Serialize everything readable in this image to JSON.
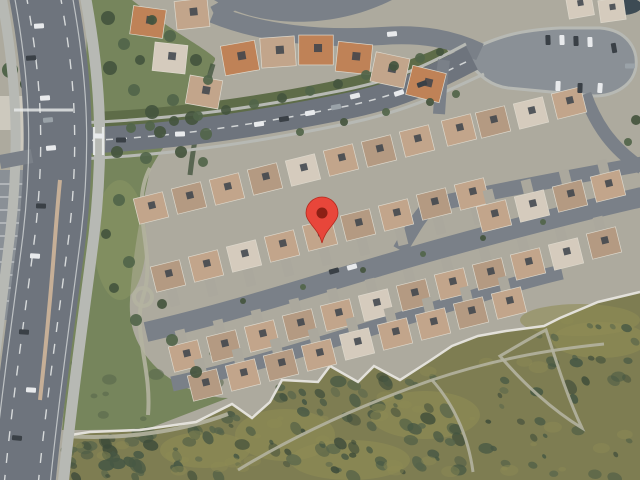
{
  "view": {
    "type": "satellite-map-view",
    "width": 640,
    "height": 480,
    "description": "aerial satellite imagery of a suburban residential neighborhood with a dropped location pin"
  },
  "marker": {
    "x": 322,
    "y": 243,
    "body_color": "#E8463A",
    "dot_color": "#8C2015",
    "outline_color": "#B5291E"
  },
  "palette": {
    "base_ground": "#ADAA9E",
    "road": "#6E747D",
    "road_minor": "#7A8088",
    "parking": "#8A9096",
    "driveway": "#ABA89D",
    "sidewalk": "#B7B9B4",
    "median_tan": "#C6AF97",
    "lane_white": "#EAECEB",
    "park_green": "#76855C",
    "lawn_light": "#8A9665",
    "green_strip": "#5E6C48",
    "tree_dark": "#44553E",
    "tree_mid": "#51654A",
    "hill_base": "#7E7D52",
    "hill_grass": "#8F8C55",
    "scrub_dark": "#475844",
    "scrub_mid": "#56644B",
    "trail": "#B4B2A0",
    "wall_white": "#E7E5DF",
    "roof_tan": "#C2A58B",
    "roof_tan2": "#B49A82",
    "roof_orange": "#BF8257",
    "roof_light": "#D5CBBD",
    "roof_edge": "#DDD8CC",
    "dark_square": "#3C434B",
    "car_white": "#E8EAEC",
    "car_dark": "#3A4046",
    "car_gray": "#9AA2A8",
    "pool_dark": "#3D4B54",
    "building_light": "#CDC9BE"
  },
  "map": {
    "houses": [
      [
        148,
        22,
        8,
        2,
        0,
        1.1
      ],
      [
        192,
        14,
        -6,
        0,
        0,
        1.1
      ],
      [
        170,
        58,
        6,
        3,
        0,
        1.1
      ],
      [
        204,
        92,
        10,
        0,
        0,
        1.1
      ],
      [
        240,
        58,
        -10,
        2,
        0,
        1.15
      ],
      [
        278,
        52,
        -4,
        0,
        0,
        1.15
      ],
      [
        316,
        50,
        0,
        2,
        0,
        1.15
      ],
      [
        354,
        58,
        6,
        2,
        0,
        1.15
      ],
      [
        390,
        70,
        12,
        0,
        0,
        1.15
      ],
      [
        426,
        84,
        14,
        2,
        0,
        1.15
      ],
      [
        151,
        208,
        -14,
        0,
        0,
        1
      ],
      [
        189,
        198,
        -14,
        1,
        0,
        1
      ],
      [
        227,
        189,
        -14,
        0,
        0,
        1
      ],
      [
        265,
        179,
        -14,
        1,
        0,
        1
      ],
      [
        303,
        170,
        -14,
        3,
        0,
        1
      ],
      [
        341,
        160,
        -14,
        0,
        0,
        1
      ],
      [
        379,
        151,
        -14,
        1,
        0,
        1
      ],
      [
        417,
        141,
        -14,
        0,
        0,
        1
      ],
      [
        459,
        130,
        -14,
        0,
        0,
        1
      ],
      [
        493,
        122,
        -14,
        1,
        0,
        1
      ],
      [
        531,
        113,
        -14,
        3,
        0,
        1
      ],
      [
        569,
        103,
        -14,
        0,
        0,
        1
      ],
      [
        168,
        276,
        -14,
        1,
        1,
        1
      ],
      [
        206,
        266,
        -14,
        0,
        1,
        1
      ],
      [
        244,
        256,
        -14,
        3,
        1,
        1
      ],
      [
        282,
        246,
        -14,
        0,
        1,
        1
      ],
      [
        320,
        235,
        -14,
        0,
        1,
        1
      ],
      [
        358,
        225,
        -14,
        1,
        1,
        1
      ],
      [
        396,
        215,
        -14,
        0,
        1,
        1
      ],
      [
        434,
        204,
        -14,
        1,
        1,
        1
      ],
      [
        472,
        194,
        -14,
        0,
        1,
        1
      ],
      [
        494,
        216,
        -14,
        0,
        -1,
        1
      ],
      [
        532,
        206,
        -14,
        3,
        -1,
        1
      ],
      [
        570,
        196,
        -14,
        1,
        -1,
        1
      ],
      [
        608,
        186,
        -14,
        0,
        -1,
        1
      ],
      [
        186,
        356,
        -14,
        0,
        -1,
        1
      ],
      [
        224,
        346,
        -14,
        1,
        -1,
        1
      ],
      [
        262,
        336,
        -14,
        0,
        -1,
        1
      ],
      [
        300,
        325,
        -14,
        1,
        -1,
        1
      ],
      [
        338,
        315,
        -14,
        0,
        -1,
        1
      ],
      [
        376,
        305,
        -14,
        3,
        -1,
        1
      ],
      [
        414,
        295,
        -14,
        1,
        -1,
        1
      ],
      [
        452,
        284,
        -14,
        0,
        -1,
        1
      ],
      [
        490,
        274,
        -14,
        1,
        -1,
        1
      ],
      [
        528,
        264,
        -14,
        0,
        -1,
        1
      ],
      [
        566,
        254,
        -14,
        3,
        -1,
        1
      ],
      [
        604,
        243,
        -14,
        1,
        -1,
        1
      ],
      [
        205,
        385,
        -14,
        1,
        -1,
        1
      ],
      [
        243,
        375,
        -14,
        0,
        -1,
        1
      ],
      [
        281,
        365,
        -14,
        1,
        -1,
        1
      ],
      [
        319,
        355,
        -14,
        0,
        -1,
        1
      ],
      [
        357,
        344,
        -14,
        3,
        -1,
        1
      ],
      [
        395,
        334,
        -14,
        0,
        -1,
        1
      ],
      [
        433,
        324,
        -14,
        0,
        -1,
        1
      ],
      [
        471,
        313,
        -14,
        1,
        -1,
        1
      ],
      [
        509,
        303,
        -14,
        0,
        -1,
        1
      ],
      [
        580,
        6,
        -10,
        3,
        0,
        0.85
      ],
      [
        612,
        10,
        -8,
        3,
        0,
        0.85
      ]
    ],
    "trees": [
      [
        108,
        18,
        7
      ],
      [
        124,
        44,
        6
      ],
      [
        110,
        68,
        7
      ],
      [
        134,
        90,
        6
      ],
      [
        152,
        112,
        7
      ],
      [
        173,
        100,
        6
      ],
      [
        192,
        118,
        7
      ],
      [
        206,
        134,
        6
      ],
      [
        160,
        132,
        6
      ],
      [
        131,
        128,
        5
      ],
      [
        117,
        152,
        6
      ],
      [
        146,
        158,
        6
      ],
      [
        181,
        152,
        6
      ],
      [
        203,
        162,
        5
      ],
      [
        152,
        20,
        5
      ],
      [
        170,
        36,
        6
      ],
      [
        196,
        60,
        6
      ],
      [
        208,
        80,
        5
      ],
      [
        140,
        60,
        5
      ],
      [
        119,
        200,
        6
      ],
      [
        106,
        234,
        5
      ],
      [
        129,
        262,
        6
      ],
      [
        114,
        288,
        5
      ],
      [
        136,
        320,
        6
      ],
      [
        162,
        304,
        5
      ],
      [
        172,
        340,
        6
      ],
      [
        196,
        372,
        6
      ],
      [
        150,
        126,
        5
      ],
      [
        174,
        121,
        5
      ],
      [
        198,
        116,
        5
      ],
      [
        226,
        110,
        5
      ],
      [
        254,
        104,
        5
      ],
      [
        282,
        98,
        5
      ],
      [
        310,
        91,
        5
      ],
      [
        338,
        84,
        5
      ],
      [
        366,
        75,
        5
      ],
      [
        394,
        66,
        5
      ],
      [
        420,
        58,
        5
      ],
      [
        440,
        52,
        4
      ],
      [
        300,
        132,
        4
      ],
      [
        344,
        122,
        4
      ],
      [
        386,
        112,
        4
      ],
      [
        430,
        102,
        4
      ],
      [
        456,
        94,
        4
      ],
      [
        243,
        301,
        3
      ],
      [
        303,
        287,
        3
      ],
      [
        363,
        270,
        3
      ],
      [
        423,
        254,
        3
      ],
      [
        483,
        238,
        3
      ],
      [
        543,
        222,
        3
      ],
      [
        636,
        120,
        5
      ],
      [
        628,
        142,
        4
      ]
    ],
    "cars": [
      [
        39,
        26,
        -4,
        "w"
      ],
      [
        31,
        58,
        -4,
        "d"
      ],
      [
        45,
        98,
        -4,
        "w"
      ],
      [
        51,
        148,
        -6,
        "w"
      ],
      [
        48,
        120,
        -5,
        "g"
      ],
      [
        41,
        206,
        2,
        "d"
      ],
      [
        35,
        256,
        3,
        "w"
      ],
      [
        24,
        332,
        4,
        "d"
      ],
      [
        31,
        390,
        4,
        "w"
      ],
      [
        17,
        438,
        5,
        "d"
      ],
      [
        99,
        136,
        2,
        "w"
      ],
      [
        121,
        140,
        0,
        "d"
      ],
      [
        180,
        134,
        -2,
        "w"
      ],
      [
        259,
        124,
        -8,
        "w"
      ],
      [
        284,
        119,
        -9,
        "d"
      ],
      [
        310,
        113,
        -10,
        "w"
      ],
      [
        336,
        107,
        -11,
        "g"
      ],
      [
        399,
        93,
        -18,
        "w"
      ],
      [
        422,
        84,
        -20,
        "d"
      ],
      [
        355,
        96,
        -13,
        "w"
      ],
      [
        392,
        34,
        -6,
        "w"
      ],
      [
        548,
        40,
        88,
        "d"
      ],
      [
        562,
        40,
        88,
        "w"
      ],
      [
        576,
        41,
        88,
        "d"
      ],
      [
        590,
        42,
        88,
        "w"
      ],
      [
        614,
        48,
        80,
        "d"
      ],
      [
        558,
        86,
        92,
        "w"
      ],
      [
        580,
        88,
        92,
        "d"
      ],
      [
        600,
        88,
        94,
        "w"
      ],
      [
        630,
        66,
        0,
        "g"
      ],
      [
        334,
        271,
        -15,
        "d"
      ],
      [
        352,
        267,
        -15,
        "w"
      ]
    ],
    "hill_wall": [
      [
        64,
        436
      ],
      [
        90,
        432
      ],
      [
        140,
        430
      ],
      [
        196,
        422
      ],
      [
        232,
        404
      ],
      [
        252,
        418
      ],
      [
        270,
        402
      ],
      [
        282,
        380
      ],
      [
        318,
        382
      ],
      [
        330,
        366
      ],
      [
        358,
        382
      ],
      [
        374,
        366
      ],
      [
        400,
        380
      ],
      [
        428,
        362
      ],
      [
        452,
        346
      ],
      [
        478,
        336
      ],
      [
        506,
        331
      ],
      [
        544,
        326
      ],
      [
        560,
        318
      ],
      [
        598,
        302
      ],
      [
        640,
        292
      ]
    ],
    "hill_patches": [
      [
        285,
        435,
        50,
        26
      ],
      [
        425,
        415,
        55,
        24
      ],
      [
        350,
        460,
        60,
        20
      ],
      [
        205,
        450,
        45,
        18
      ],
      [
        600,
        340,
        48,
        18
      ],
      [
        580,
        320,
        60,
        16
      ]
    ],
    "park_plaza": {
      "x": 143,
      "y": 297,
      "r": 9
    }
  }
}
